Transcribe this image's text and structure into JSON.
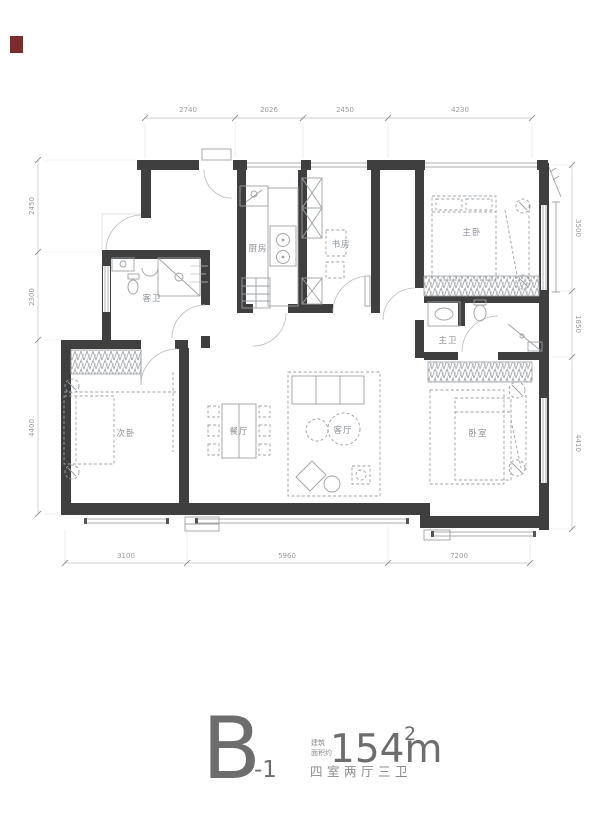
{
  "window_marker": {
    "color": "#7e2b2b"
  },
  "plan": {
    "rooms": [
      {
        "id": "kitchen",
        "label": "厨房"
      },
      {
        "id": "study",
        "label": "书房"
      },
      {
        "id": "master-bedroom",
        "label": "主卧"
      },
      {
        "id": "master-bath",
        "label": "主卫"
      },
      {
        "id": "guest-bath",
        "label": "客卫"
      },
      {
        "id": "bedroom-left",
        "label": "次卧"
      },
      {
        "id": "bedroom-right",
        "label": "卧室"
      },
      {
        "id": "dining",
        "label": "餐厅"
      },
      {
        "id": "living",
        "label": "客厅"
      }
    ],
    "dimensions": {
      "top": [
        "2740",
        "2026",
        "2450",
        "4230"
      ],
      "bottom": [
        "3100",
        "5960",
        "7200"
      ],
      "left": [
        "2450",
        "2300",
        "4400"
      ],
      "right": [
        "3500",
        "1850",
        "4410"
      ]
    }
  },
  "title": {
    "letter": "B",
    "suffix": "-1",
    "area_prefix_line1": "建筑",
    "area_prefix_line2": "面积约",
    "area_value": "154m",
    "area_sup": "2",
    "subtitle": "四室两厅三卫"
  }
}
